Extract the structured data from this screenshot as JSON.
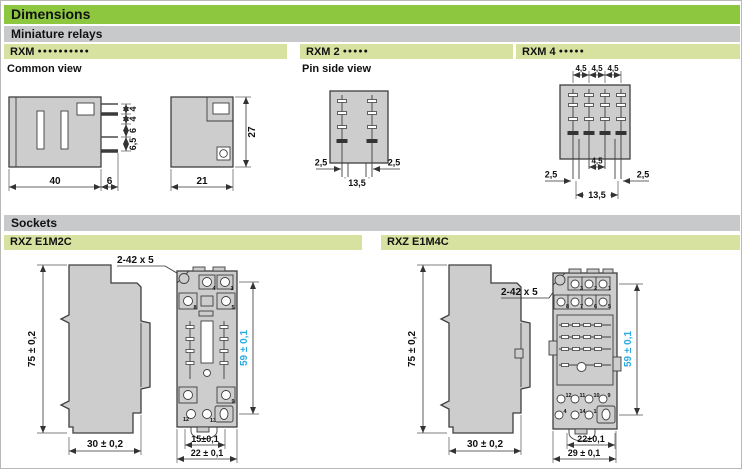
{
  "header": {
    "title": "Dimensions",
    "subtitle": "Miniature relays",
    "sockets_title": "Sockets"
  },
  "colors": {
    "header_green": "#8DC63F",
    "bar_gray": "#C8C9CB",
    "bar_light_green": "#D8E2A0",
    "dim_blue": "#29ABE2",
    "drawing_fill": "#CDCDCD"
  },
  "relays": {
    "rxm_all": {
      "model": "RXM",
      "dots": "●●●●●●●●●●",
      "view": "Common view",
      "side": {
        "body_width": "40",
        "pin_length": "6",
        "gaps": [
          "4",
          "4",
          "6",
          "6,5"
        ]
      },
      "front": {
        "width": "21",
        "height": "27"
      }
    },
    "rxm2": {
      "model": "RXM 2",
      "dots": "●●●●●",
      "view": "Pin side view",
      "dims": {
        "left": "2,5",
        "right": "2,5",
        "span": "13,5"
      }
    },
    "rxm4": {
      "model": "RXM 4",
      "dots": "●●●●●",
      "dims": {
        "top": [
          "4,5",
          "4,5",
          "4,5"
        ],
        "middle": "4,5",
        "left": "2,5",
        "right": "2,5",
        "span": "13,5"
      }
    }
  },
  "sockets": {
    "e1m2c": {
      "model": "RXZ E1M2C",
      "screws": "2-42 x 5",
      "side": {
        "height": "75 ± 0,2",
        "width": "30 ± 0,2"
      },
      "front": {
        "height": "59 ± 0,1",
        "inner_width": "15±0,1",
        "width": "22 ± 0,1",
        "terminals": {
          "t4": "4",
          "t1": "1",
          "t8": "8",
          "t5": "5",
          "t9": "9",
          "t12": "12",
          "t13": "13"
        }
      }
    },
    "e1m4c": {
      "model": "RXZ E1M4C",
      "screws": "2-42 x 5",
      "side": {
        "height": "75 ± 0,2",
        "width": "30 ± 0,2"
      },
      "front": {
        "height": "59 ± 0,1",
        "inner_width": "22±0,1",
        "width": "29 ± 0,1",
        "terminals": {
          "row1": [
            "3",
            "2",
            "1"
          ],
          "row2": [
            "8",
            "7",
            "6",
            "5"
          ],
          "row3": [
            "12",
            "11",
            "10",
            "9"
          ],
          "row4": [
            "4",
            "14",
            "13"
          ]
        }
      }
    }
  }
}
